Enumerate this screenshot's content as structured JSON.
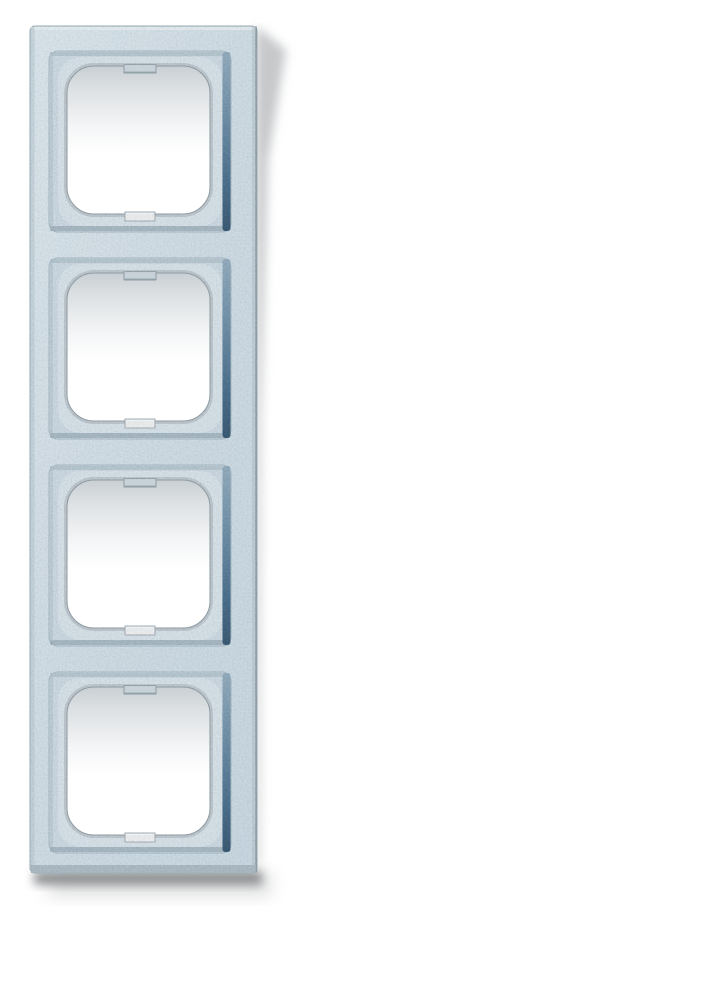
{
  "page": {
    "background_color": "#ffffff"
  },
  "product_photo": {
    "alt": "Four-gang vertical cover frame for flush-mounted switch range, silver-blue speckled metallic finish, photographed on a white background with a soft drop shadow to the right and below",
    "gang_count": 4,
    "orientation": "vertical",
    "windows": [
      {
        "label": "window-1"
      },
      {
        "label": "window-2"
      },
      {
        "label": "window-3"
      },
      {
        "label": "window-4"
      }
    ],
    "colors": {
      "background": "#ffffff",
      "frame_surface": "#cfdde7",
      "recess_surface": "#c7d7e2",
      "recess_edge_shadow_dark": "#1c4261",
      "recess_edge_shadow_light": "#85a3b8",
      "opening_rim": "#b7c3ca",
      "opening_interior_shadow": "#ccd2d5",
      "drop_shadow": "#8e9296"
    }
  }
}
